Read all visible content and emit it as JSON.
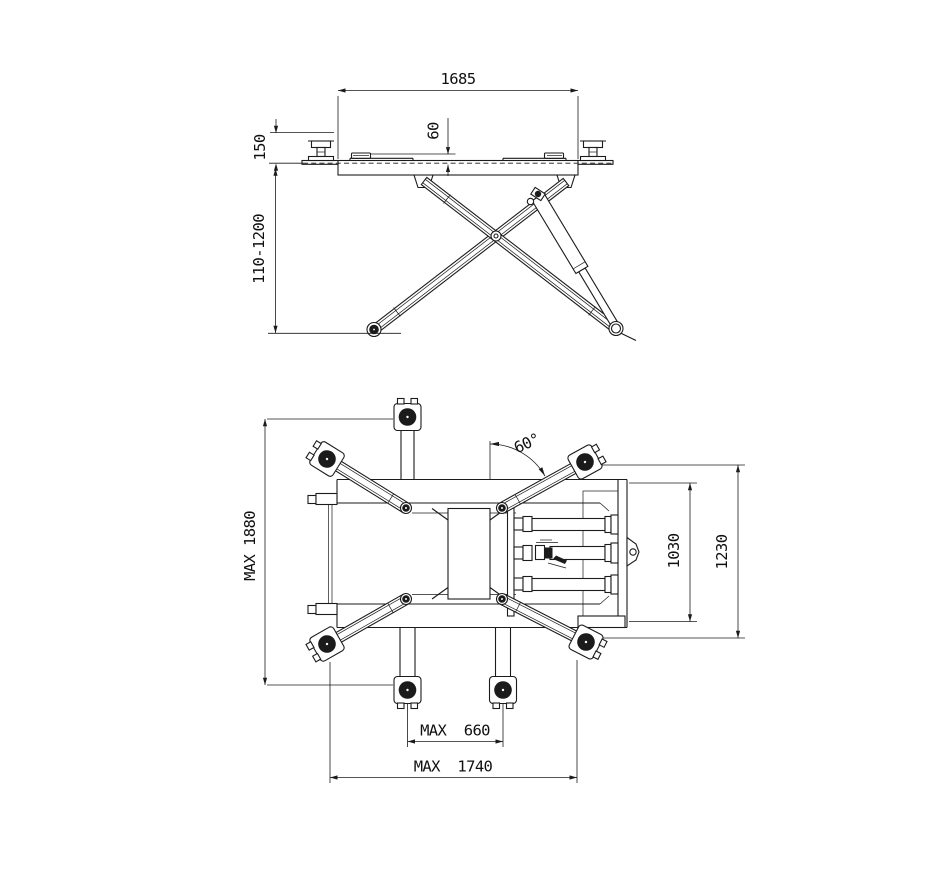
{
  "colors": {
    "line": "#1b1b1b",
    "background": "#ffffff"
  },
  "side_view": {
    "overall_length": "1685",
    "pad_height": "60",
    "min_pad_height": "150",
    "lifting_height_range": "110-1200"
  },
  "plan_view": {
    "max_frame_length": "MAX 1880",
    "arm_swing_angle": "60°",
    "base_frame_width": "1030",
    "overall_width": "1230",
    "pad_spread_min": "MAX  660",
    "pad_spread_max": "MAX  1740"
  }
}
